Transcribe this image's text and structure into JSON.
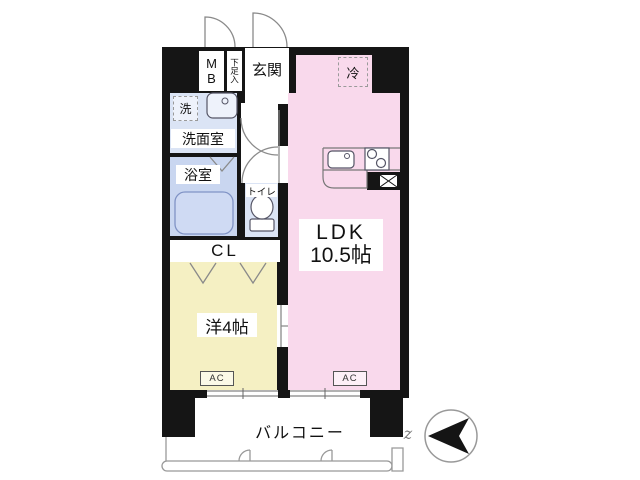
{
  "floorplan": {
    "unit": {
      "entrance_label": "玄関",
      "meter_box_label": "MB",
      "shoe_box_label": "下足入",
      "refrigerator_label": "冷",
      "washroom_label": "洗面室",
      "washer_label": "洗",
      "bathroom_label": "浴室",
      "toilet_label": "トイレ",
      "closet_label": "CL",
      "western_room_label": "洋4帖",
      "ldk_label": "LDK",
      "ldk_size": "10.5帖",
      "ac_label": "AC",
      "balcony_label": "バルコニー",
      "break_mark": "z"
    },
    "colors": {
      "wall": "#151515",
      "ldk": "#f9d9ec",
      "western_room": "#f5f0c3",
      "bathroom": "#c9d6f0",
      "washroom": "#dbe4f5",
      "background": "#ffffff"
    }
  }
}
